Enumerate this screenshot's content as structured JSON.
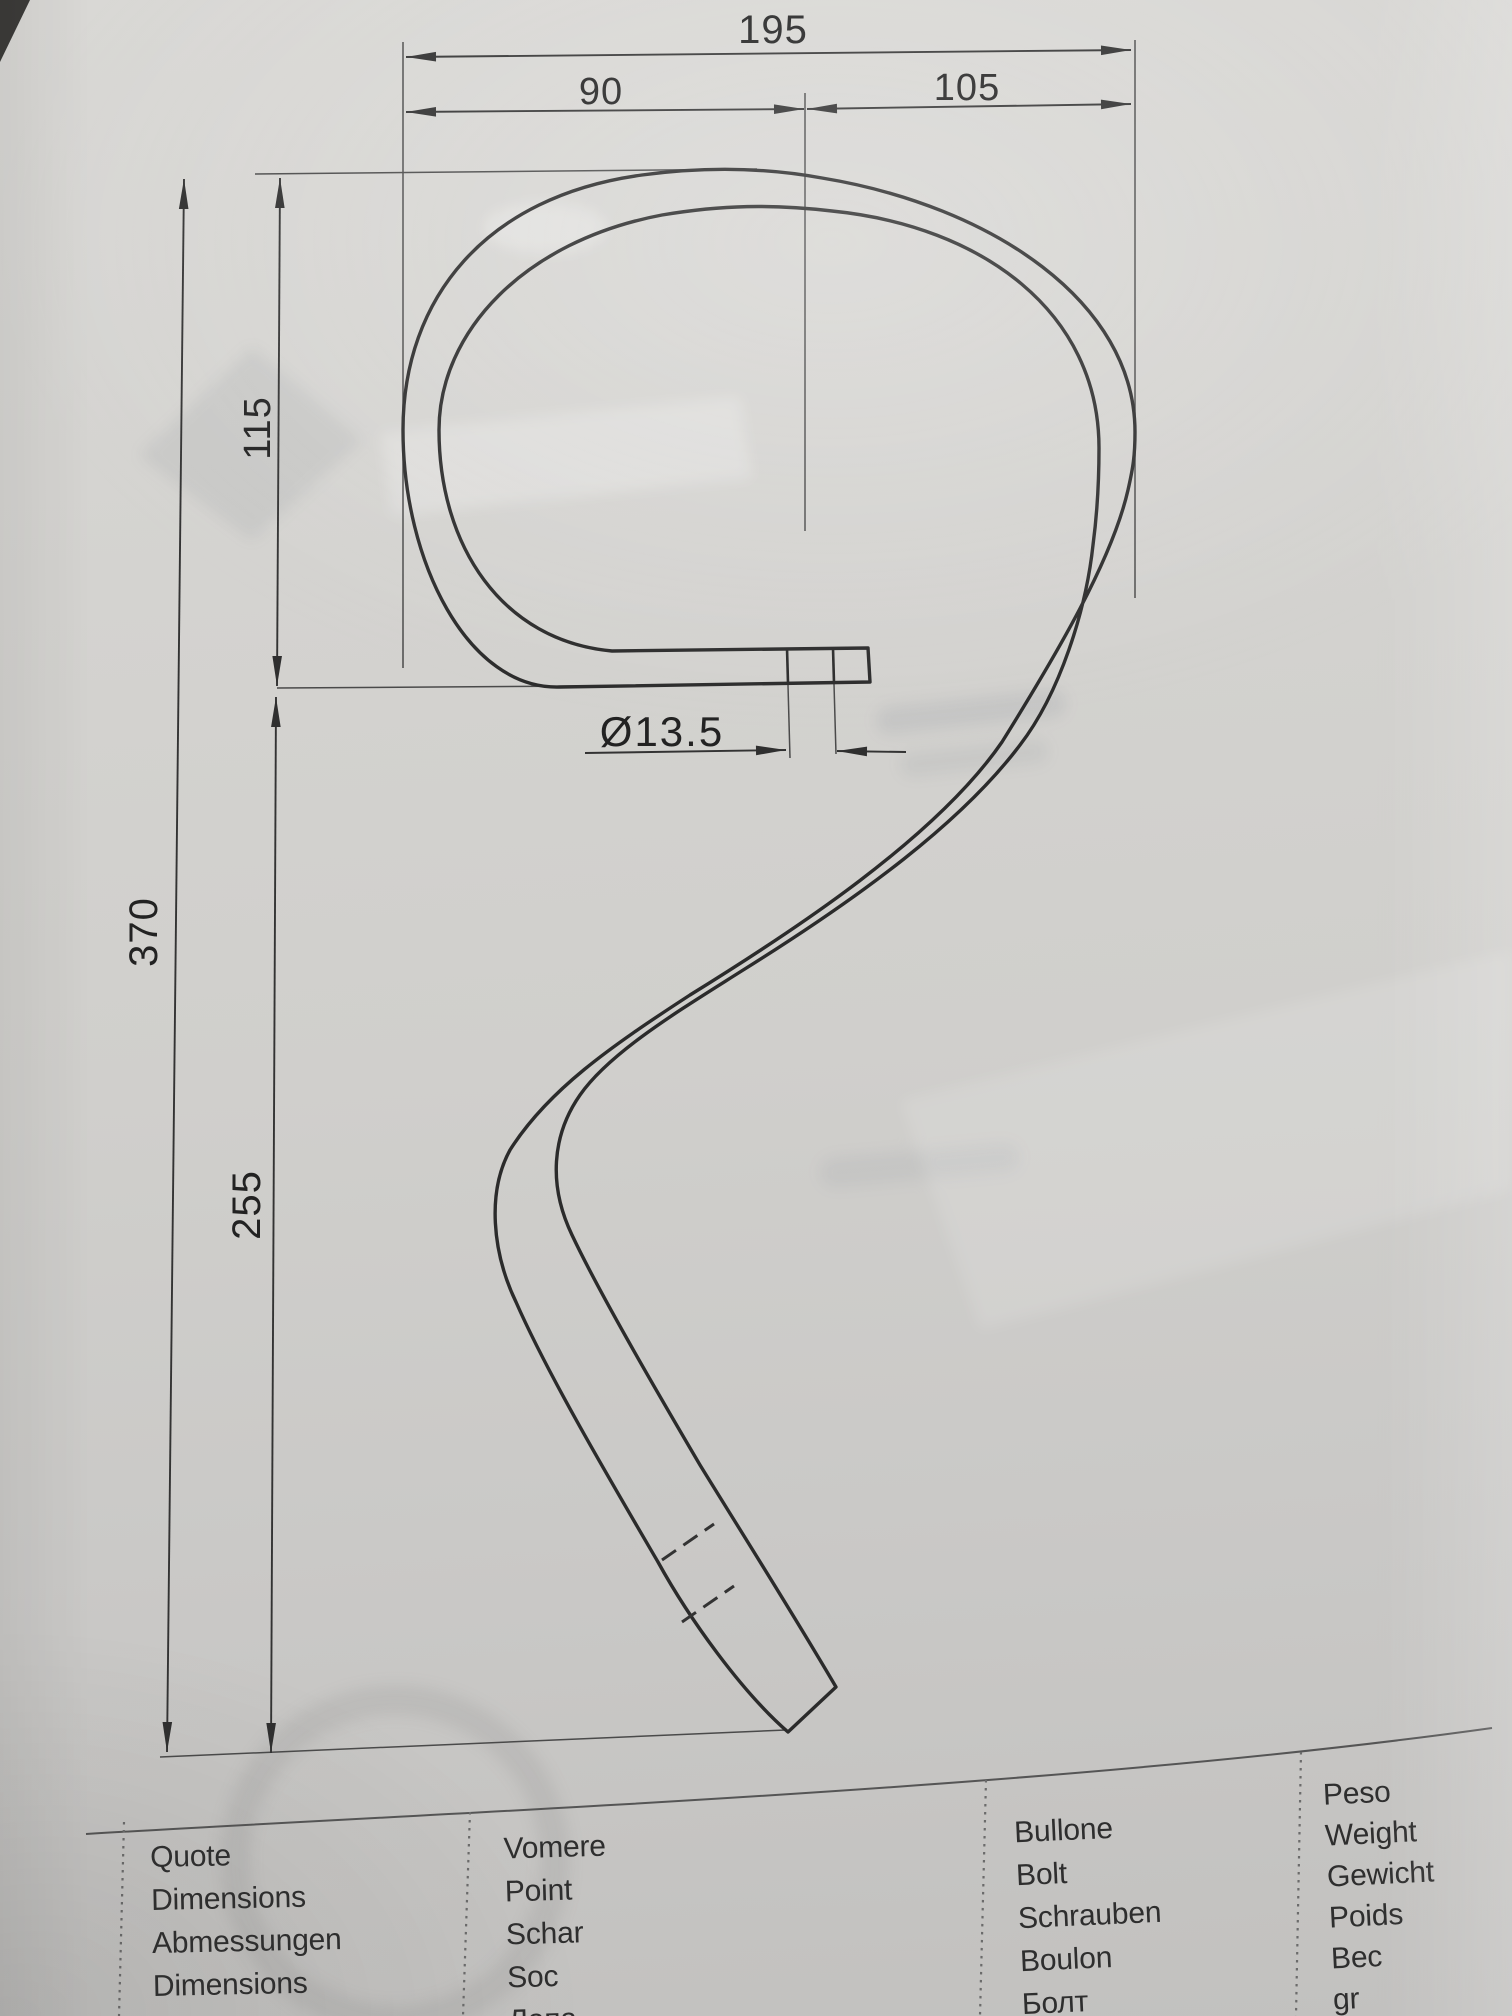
{
  "drawing": {
    "dims": {
      "width_total": "195",
      "width_left": "90",
      "width_right": "105",
      "height_top": "115",
      "height_total": "370",
      "height_bottom": "255",
      "hole_diameter": "Ø13.5"
    }
  },
  "table": {
    "columns": [
      {
        "id": "quote",
        "lines": [
          "Quote",
          "Dimensions",
          "Abmessungen",
          "Dimensions",
          "Размеры"
        ]
      },
      {
        "id": "vomere",
        "lines": [
          "Vomere",
          "Point",
          "Schar",
          "Soc",
          "Лапа"
        ]
      },
      {
        "id": "bullone",
        "lines": [
          "Bullone",
          "Bolt",
          "Schrauben",
          "Boulon",
          "Болт"
        ]
      },
      {
        "id": "peso",
        "lines": [
          "Peso",
          "Weight",
          "Gewicht",
          "Poids",
          "Вес",
          "gr"
        ]
      }
    ]
  },
  "colors": {
    "paper": "#d0cfcc",
    "line": "#2b2b2b",
    "dim_line": "#333333",
    "text": "#222222"
  }
}
